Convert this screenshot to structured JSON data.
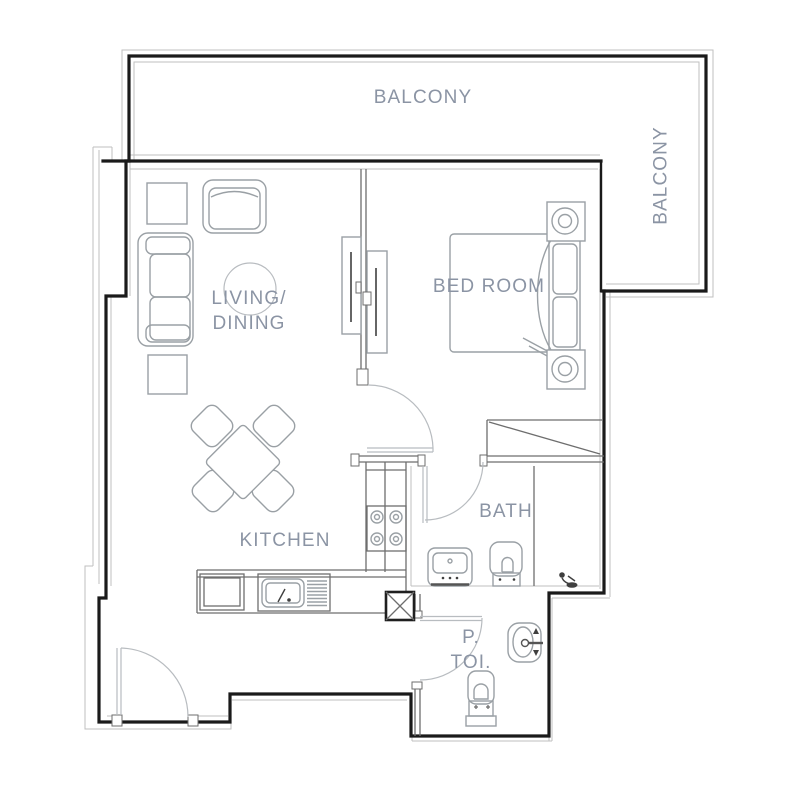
{
  "rooms": {
    "balcony_top": "BALCONY",
    "balcony_right": "BALCONY",
    "living_line1": "LIVING/",
    "living_line2": "DINING",
    "bedroom": "BED ROOM",
    "kitchen": "KITCHEN",
    "bath": "BATH",
    "ptoi_line1": "P.",
    "ptoi_line2": "TOI."
  },
  "colors": {
    "wall": "#1a1a1a",
    "partition": "#6e6e6e",
    "furniture": "#9aa0a5",
    "thin": "#bfbfbf",
    "label": "#8b94a4",
    "dark": "#3f3f3f"
  }
}
